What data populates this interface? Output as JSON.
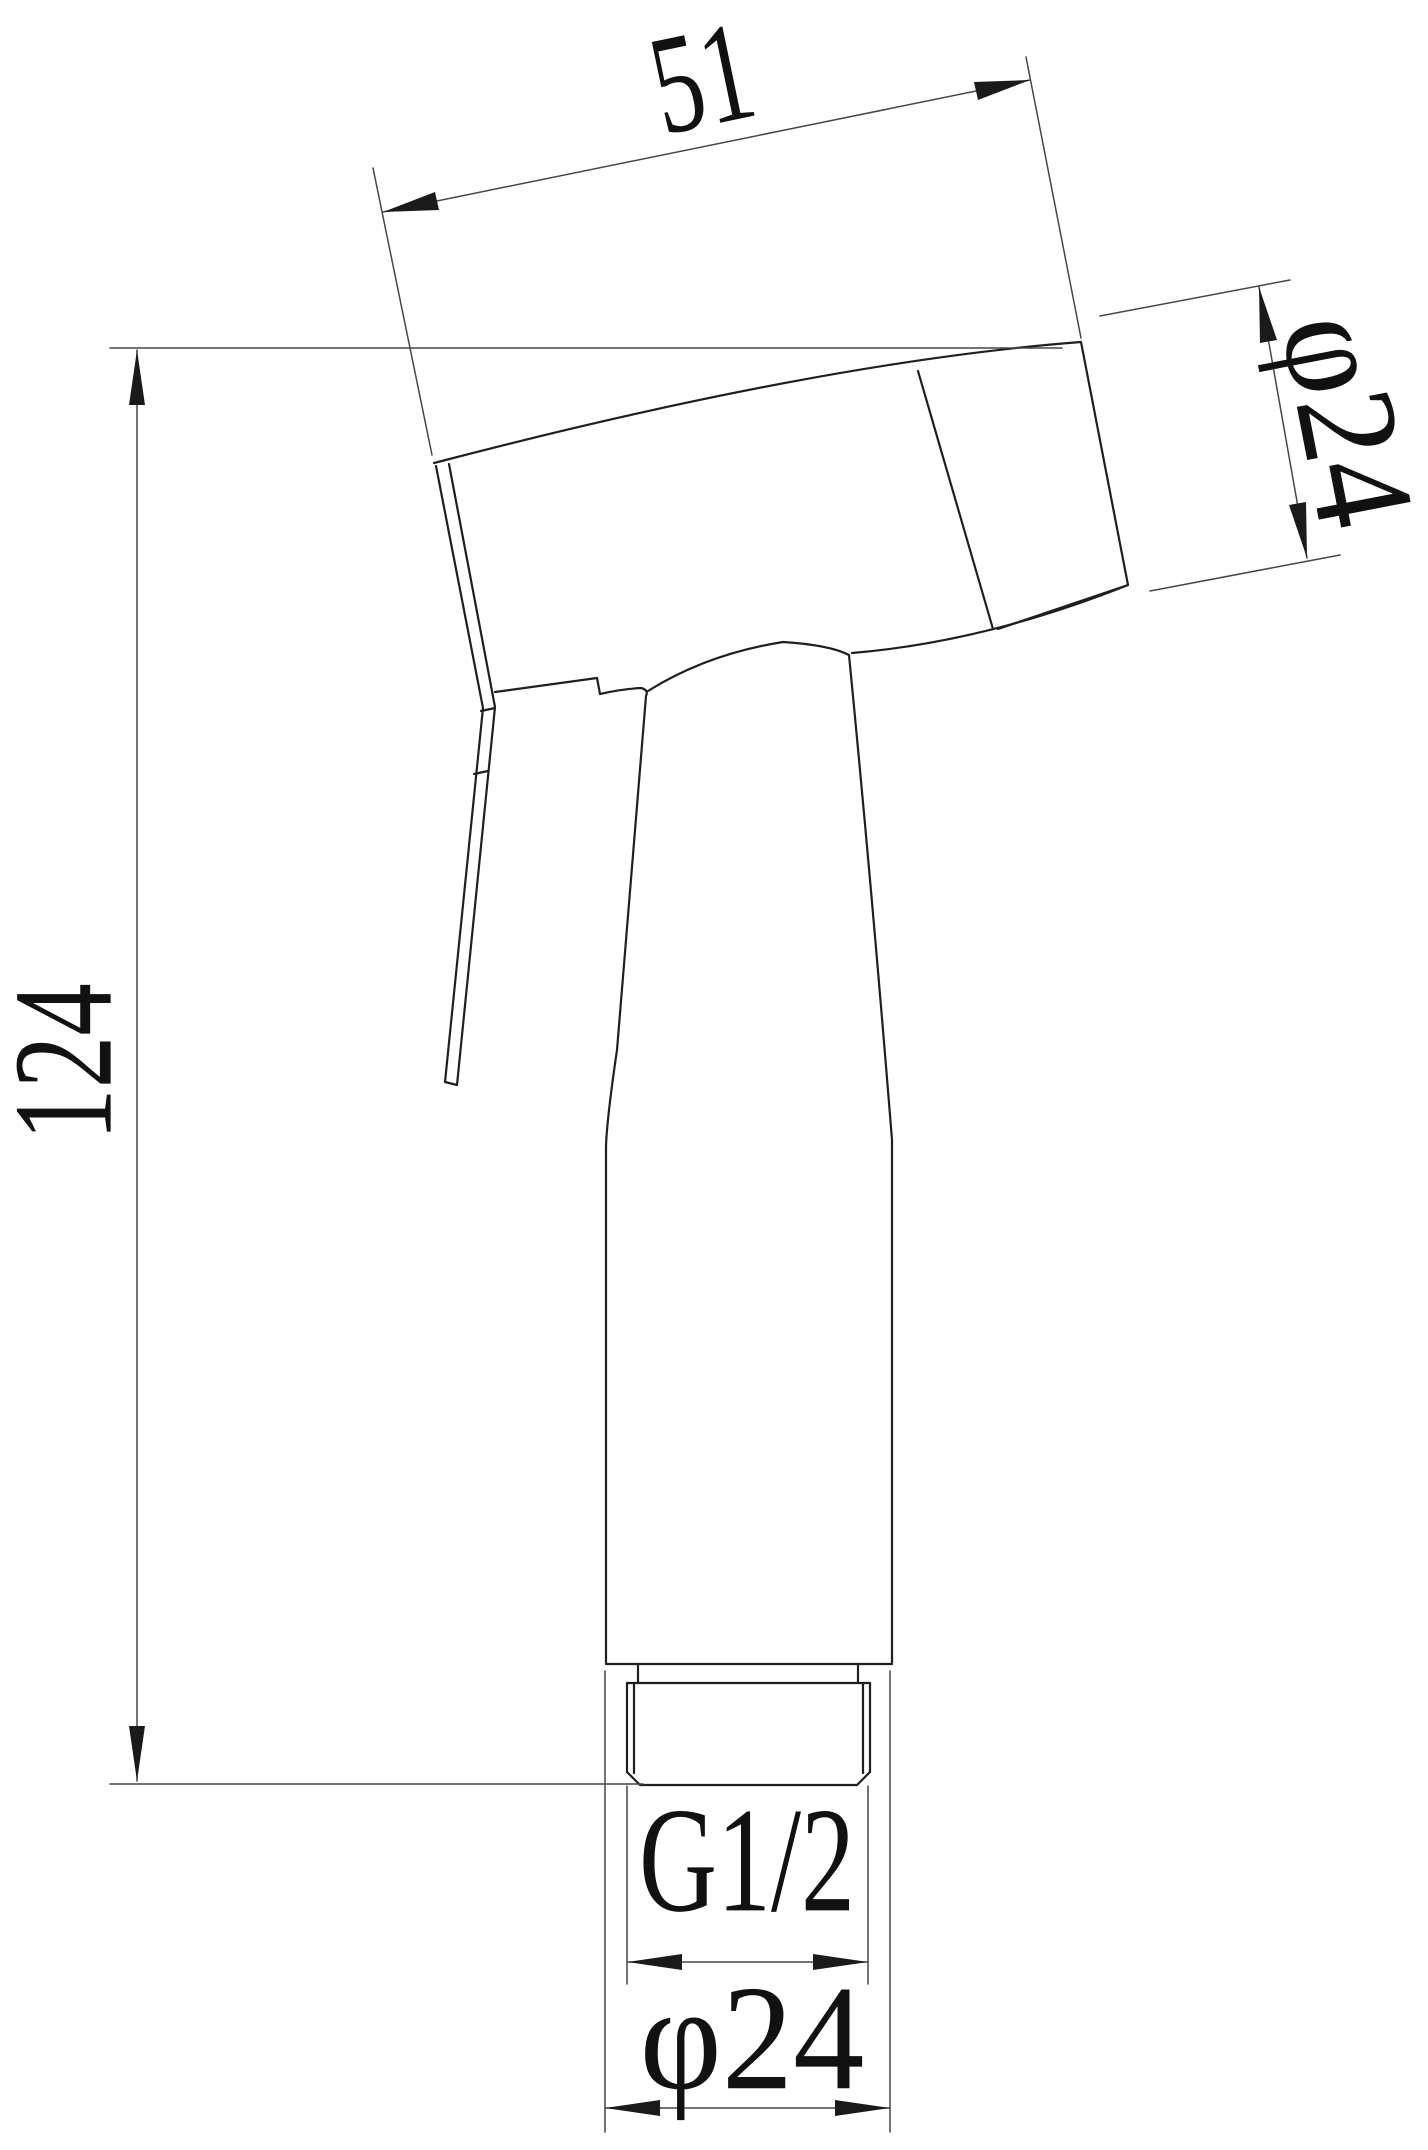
{
  "figure": {
    "description": "Technical line drawing: handheld bidet sprayer head, side view with dimension annotations",
    "dimensions": {
      "head_width": {
        "text": "51"
      },
      "head_diameter": {
        "text": "φ24"
      },
      "overall_height": {
        "text": "124"
      },
      "thread_spec": {
        "text": "G1/2"
      },
      "base_diameter": {
        "text": "φ24"
      }
    },
    "colors": {
      "background": "#ffffff",
      "object_line": "#1f1f1f",
      "dimension_line": "#474747",
      "arrow_fill": "#1a1a1a",
      "text_color": "#111111"
    }
  }
}
